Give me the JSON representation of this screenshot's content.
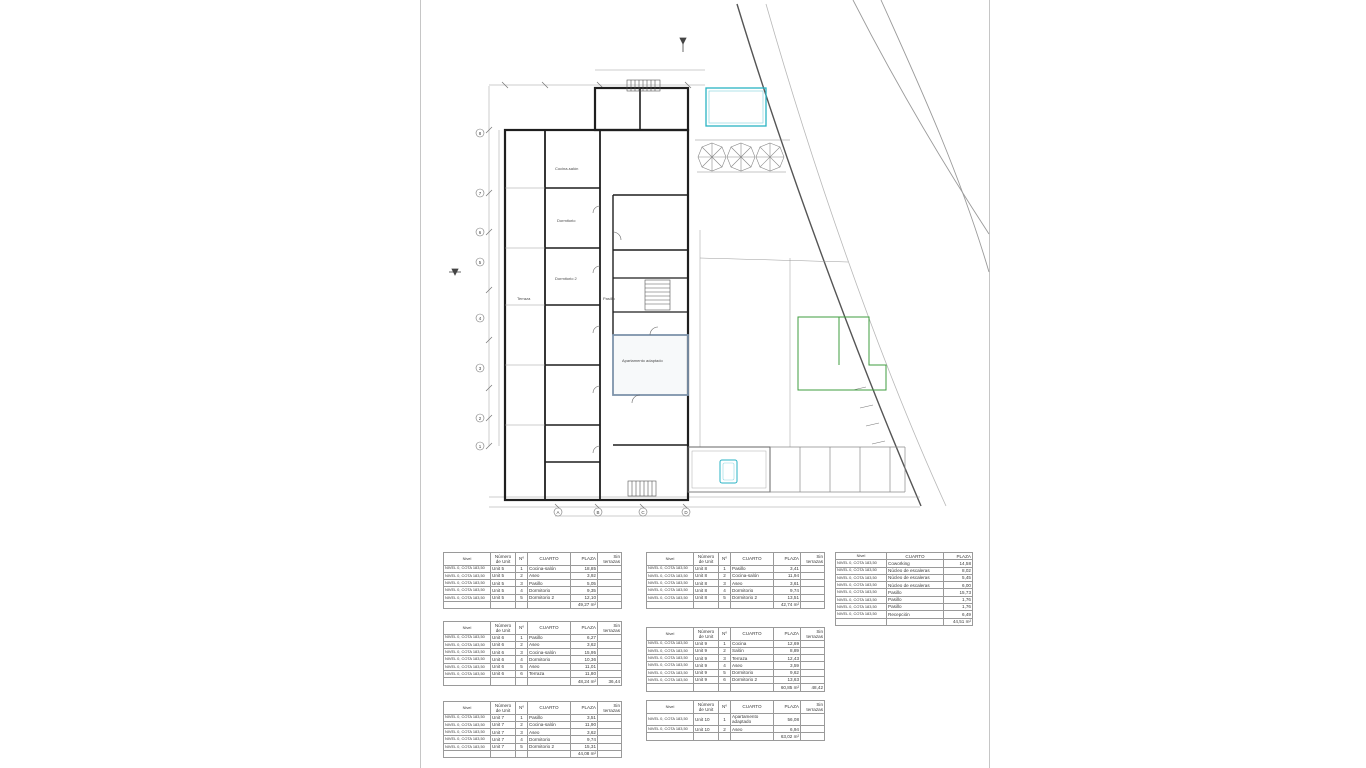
{
  "plan": {
    "labels": {
      "cocina_salon": "Cocina-salón",
      "dormitorio": "Dormitorio",
      "dormitorio2": "Dormitorio 2",
      "terraza": "Terraza",
      "apartamento_adaptado": "Apartamento adaptado",
      "pasillo": "Pasillo"
    },
    "grid_letters": [
      "A",
      "B",
      "C",
      "D"
    ],
    "grid_numbers": [
      "8",
      "7",
      "6",
      "5",
      "4",
      "3",
      "2",
      "1"
    ],
    "colors": {
      "pool": "#2ab3c4",
      "landscape": "#3f9e3f",
      "wall": "#1f1f1f",
      "highlight": "#7d93ab"
    }
  },
  "tables": {
    "unit5": {
      "headers": [
        "Nivel",
        "Número de Unit",
        "Nº",
        "CUARTO",
        "PLAZA",
        "Sin terrazas"
      ],
      "rows": [
        [
          "NIVEL 0, COTA 183,50",
          "Unit 5",
          "1",
          "Cocina-salón",
          "18,85",
          ""
        ],
        [
          "NIVEL 0, COTA 183,50",
          "Unit 5",
          "2",
          "Aseo",
          "3,92",
          ""
        ],
        [
          "NIVEL 0, COTA 183,50",
          "Unit 5",
          "3",
          "Pasillo",
          "5,05",
          ""
        ],
        [
          "NIVEL 0, COTA 183,50",
          "Unit 5",
          "4",
          "Dormitorio",
          "9,35",
          ""
        ],
        [
          "NIVEL 0, COTA 183,50",
          "Unit 5",
          "5",
          "Dormitorio 2",
          "12,10",
          ""
        ],
        [
          "",
          "",
          "",
          "",
          "49,27 m²",
          ""
        ]
      ]
    },
    "unit6": {
      "headers": [
        "Nivel",
        "Número de Unit",
        "Nº",
        "CUARTO",
        "PLAZA",
        "Sin terrazas"
      ],
      "rows": [
        [
          "NIVEL 0, COTA 183,50",
          "Unit 6",
          "1",
          "Pasillo",
          "6,27",
          ""
        ],
        [
          "NIVEL 0, COTA 183,50",
          "Unit 6",
          "2",
          "Aseo",
          "3,62",
          ""
        ],
        [
          "NIVEL 0, COTA 183,50",
          "Unit 6",
          "3",
          "Cocina-salón",
          "15,95",
          ""
        ],
        [
          "NIVEL 0, COTA 183,50",
          "Unit 6",
          "4",
          "Dormitorio",
          "10,36",
          ""
        ],
        [
          "NIVEL 0, COTA 183,50",
          "Unit 6",
          "5",
          "Aseo",
          "11,01",
          ""
        ],
        [
          "NIVEL 0, COTA 183,50",
          "Unit 6",
          "6",
          "Terraza",
          "11,80",
          ""
        ],
        [
          "",
          "",
          "",
          "",
          "48,24 m²",
          "36,44"
        ]
      ]
    },
    "unit7": {
      "headers": [
        "Nivel",
        "Número de Unit",
        "Nº",
        "CUARTO",
        "PLAZA",
        "Sin terrazas"
      ],
      "rows": [
        [
          "NIVEL 0, COTA 183,50",
          "Unit 7",
          "1",
          "Pasillo",
          "3,51",
          ""
        ],
        [
          "NIVEL 0, COTA 183,50",
          "Unit 7",
          "2",
          "Cocina-salón",
          "11,90",
          ""
        ],
        [
          "NIVEL 0, COTA 183,50",
          "Unit 7",
          "3",
          "Aseo",
          "3,62",
          ""
        ],
        [
          "NIVEL 0, COTA 183,50",
          "Unit 7",
          "4",
          "Dormitorio",
          "9,74",
          ""
        ],
        [
          "NIVEL 0, COTA 183,50",
          "Unit 7",
          "5",
          "Dormitorio 2",
          "15,31",
          ""
        ],
        [
          "",
          "",
          "",
          "",
          "44,08 m²",
          ""
        ]
      ]
    },
    "unit8": {
      "headers": [
        "Nivel",
        "Número de Unit",
        "Nº",
        "CUARTO",
        "PLAZA",
        "Sin terrazas"
      ],
      "rows": [
        [
          "NIVEL 0, COTA 183,50",
          "Unit 8",
          "1",
          "Pasillo",
          "3,41",
          ""
        ],
        [
          "NIVEL 0, COTA 183,50",
          "Unit 8",
          "2",
          "Cocina-salón",
          "11,94",
          ""
        ],
        [
          "NIVEL 0, COTA 183,50",
          "Unit 8",
          "3",
          "Aseo",
          "3,61",
          ""
        ],
        [
          "NIVEL 0, COTA 183,50",
          "Unit 8",
          "4",
          "Dormitorio",
          "9,74",
          ""
        ],
        [
          "NIVEL 0, COTA 183,50",
          "Unit 8",
          "5",
          "Dormitorio 2",
          "13,51",
          ""
        ],
        [
          "",
          "",
          "",
          "",
          "42,74 m²",
          ""
        ]
      ]
    },
    "unit9": {
      "headers": [
        "Nivel",
        "Número de Unit",
        "Nº",
        "CUARTO",
        "PLAZA",
        "Sin terrazas"
      ],
      "rows": [
        [
          "NIVEL 0, COTA 183,50",
          "Unit 9",
          "1",
          "Cocina",
          "12,69",
          ""
        ],
        [
          "NIVEL 0, COTA 183,50",
          "Unit 9",
          "2",
          "Salón",
          "8,89",
          ""
        ],
        [
          "NIVEL 0, COTA 183,50",
          "Unit 9",
          "3",
          "Terraza",
          "12,43",
          ""
        ],
        [
          "NIVEL 0, COTA 183,50",
          "Unit 9",
          "4",
          "Aseo",
          "3,59",
          ""
        ],
        [
          "NIVEL 0, COTA 183,50",
          "Unit 9",
          "5",
          "Dormitorio",
          "9,62",
          ""
        ],
        [
          "NIVEL 0, COTA 183,50",
          "Unit 9",
          "6",
          "Dormitorio 2",
          "13,63",
          ""
        ],
        [
          "",
          "",
          "",
          "",
          "60,85 m²",
          "48,42"
        ]
      ]
    },
    "unit10": {
      "headers": [
        "Nivel",
        "Número de Unit",
        "Nº",
        "CUARTO",
        "PLAZA",
        "Sin terrazas"
      ],
      "rows": [
        [
          "NIVEL 0, COTA 183,50",
          "Unit 10",
          "1",
          "Apartamento adaptado",
          "56,08",
          ""
        ],
        [
          "NIVEL 0, COTA 183,50",
          "Unit 10",
          "2",
          "Aseo",
          "6,94",
          ""
        ],
        [
          "",
          "",
          "",
          "",
          "63,02 m²",
          ""
        ]
      ]
    },
    "common": {
      "headers": [
        "Nivel",
        "CUARTO",
        "PLAZA"
      ],
      "rows": [
        [
          "NIVEL 0, COTA 183,50",
          "Coworking",
          "14,58"
        ],
        [
          "NIVEL 0, COTA 183,50",
          "Núcleo de escaleras",
          "8,02"
        ],
        [
          "NIVEL 0, COTA 183,50",
          "Núcleo de escaleras",
          "5,45"
        ],
        [
          "NIVEL 0, COTA 183,50",
          "Núcleo de escaleras",
          "6,00"
        ],
        [
          "NIVEL 0, COTA 183,50",
          "Pasillo",
          "15,73"
        ],
        [
          "NIVEL 0, COTA 183,50",
          "Pasillo",
          "1,76"
        ],
        [
          "NIVEL 0, COTA 183,50",
          "Pasillo",
          "1,76"
        ],
        [
          "NIVEL 0, COTA 183,50",
          "Recepción",
          "6,49"
        ],
        [
          "",
          "",
          "44,51 m²"
        ]
      ]
    }
  }
}
